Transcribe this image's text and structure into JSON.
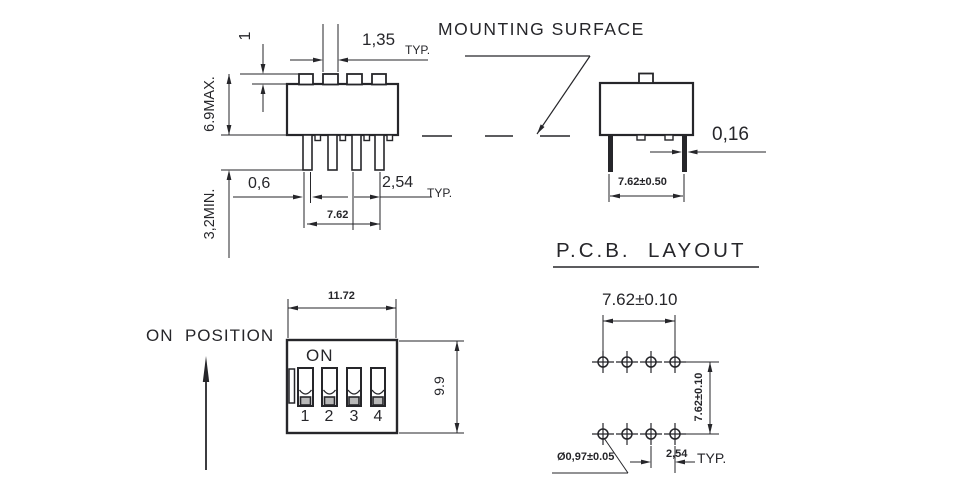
{
  "labels": {
    "mounting_surface": "MOUNTING SURFACE",
    "pcb_layout": "P.C.B.  LAYOUT",
    "on_position": "ON  POSITION"
  },
  "side_view": {
    "actuator_height": "1",
    "actuator_width": "1,35",
    "actuator_width_typ": "TYP.",
    "body_height": "6.9MAX.",
    "lead_length": "3,2MIN.",
    "lead_width": "0,6",
    "lead_pitch": "2,54",
    "lead_pitch_typ": "TYP.",
    "row_spacing": "7.62"
  },
  "end_view": {
    "lead_thickness": "0,16",
    "lead_span": "7.62±0.50"
  },
  "front_view": {
    "on_label": "ON",
    "positions": [
      "1",
      "2",
      "3",
      "4"
    ],
    "width": "11.72",
    "height": "9.9"
  },
  "pcb_layout": {
    "column_span": "7.62±0.10",
    "row_span": "7.62±0.10",
    "hole_diameter": "Ø0,97±0.05",
    "hole_pitch": "2,54",
    "hole_pitch_typ": "TYP."
  },
  "colors": {
    "line": "#26262a",
    "knob_fill": "#b9b9b9",
    "background": "#ffffff"
  }
}
